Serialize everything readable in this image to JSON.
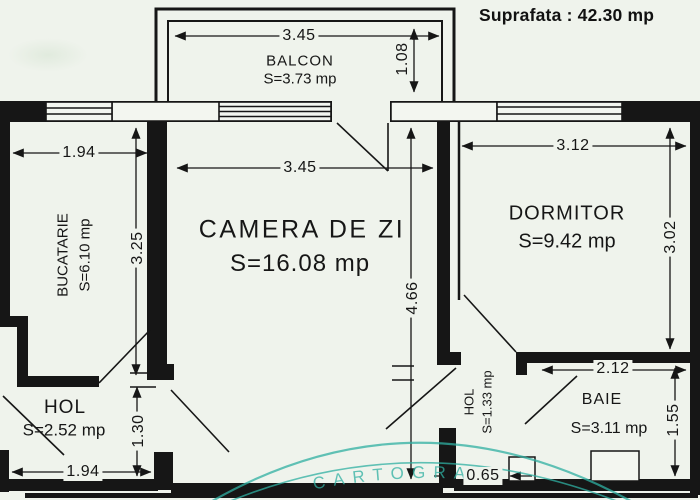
{
  "header": {
    "total_area": "Suprafata : 42.30 mp"
  },
  "rooms": {
    "balcon": {
      "name": "BALCON",
      "area": "S=3.73  mp"
    },
    "camera_de_zi": {
      "name": "CAMERA  DE  ZI",
      "area": "S=16.08  mp"
    },
    "dormitor": {
      "name": "DORMITOR",
      "area": "S=9.42  mp"
    },
    "bucatarie": {
      "name": "BUCATARIE",
      "area": "S=6.10  mp"
    },
    "hol_1": {
      "name": "HOL",
      "area": "S=2.52  mp"
    },
    "hol_2": {
      "name": "HOL",
      "area": "S=1.33  mp"
    },
    "baie": {
      "name": "BAIE",
      "area": "S=3.11  mp"
    }
  },
  "dimensions": {
    "balcon_width": "3.45",
    "balcon_depth": "1.08",
    "bucatarie_width": "1.94",
    "bucatarie_depth": "3.25",
    "camera_width": "3.45",
    "camera_depth": "4.66",
    "dormitor_width": "3.12",
    "dormitor_depth": "3.02",
    "hol_depth": "1.30",
    "hol_width": "1.94",
    "door_width": "0.65",
    "baie_width": "2.12",
    "baie_depth": "1.55"
  },
  "stamp": {
    "text": "CARTOGRAF",
    "color": "#2fb0a2"
  },
  "colors": {
    "paper": "#eff3ec",
    "ink": "#161616",
    "wall": "#161616"
  }
}
